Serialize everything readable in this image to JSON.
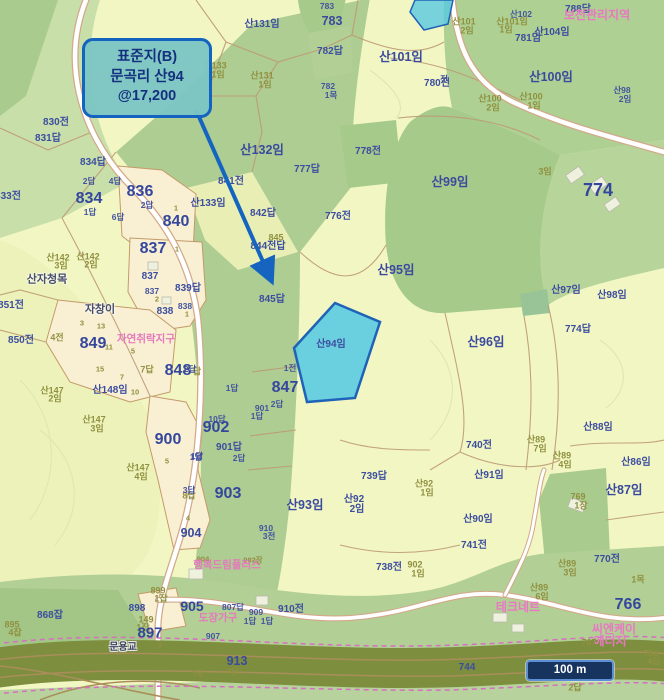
{
  "callout": {
    "line1": "표준지(B)",
    "line2": "문곡리 산94",
    "line3": "@17,200"
  },
  "scale_bar": {
    "label": "100 m"
  },
  "highlight": {
    "label": "산94임",
    "fill": "#57c9e2",
    "border": "#1f63b8"
  },
  "colors": {
    "accent_blue": "#1565c0",
    "callout_fill": "#7cc6c4",
    "callout_text": "#15307f",
    "parcel_blue_text": "#3c4d9f",
    "olive_text": "#8f9140",
    "pink_text": "#e678bd",
    "forest_green": "#aecd92",
    "pale_field": "#f2f6c3",
    "rail_band": "#7d8e3e"
  },
  "labels": [
    {
      "t": "783",
      "x": 327,
      "y": 6,
      "c": "bs"
    },
    {
      "t": "산131임",
      "x": 262,
      "y": 25,
      "c": "b"
    },
    {
      "t": "783",
      "x": 332,
      "y": 21,
      "c": "bm"
    },
    {
      "t": "782답",
      "x": 330,
      "y": 52,
      "c": "b"
    },
    {
      "t": "782",
      "x": 328,
      "y": 86,
      "c": "bs"
    },
    {
      "t": "1목",
      "x": 331,
      "y": 95,
      "c": "bs"
    },
    {
      "t": "산101임",
      "x": 401,
      "y": 57,
      "c": "bm"
    },
    {
      "t": "780전",
      "x": 437,
      "y": 84,
      "c": "b"
    },
    {
      "t": "산133",
      "x": 215,
      "y": 66,
      "c": "o"
    },
    {
      "t": "1임",
      "x": 218,
      "y": 75,
      "c": "o"
    },
    {
      "t": "산131",
      "x": 262,
      "y": 76,
      "c": "o"
    },
    {
      "t": "1임",
      "x": 265,
      "y": 85,
      "c": "o"
    },
    {
      "t": "산101",
      "x": 464,
      "y": 22,
      "c": "o"
    },
    {
      "t": "2임",
      "x": 467,
      "y": 31,
      "c": "o"
    },
    {
      "t": "산102",
      "x": 521,
      "y": 14,
      "c": "bs"
    },
    {
      "t": "산101임",
      "x": 512,
      "y": 22,
      "c": "o"
    },
    {
      "t": "1임",
      "x": 506,
      "y": 30,
      "c": "o"
    },
    {
      "t": "781임",
      "x": 528,
      "y": 39,
      "c": "b"
    },
    {
      "t": "산104임",
      "x": 552,
      "y": 33,
      "c": "b"
    },
    {
      "t": "788답",
      "x": 578,
      "y": 10,
      "c": "b"
    },
    {
      "t": "보전관리지역",
      "x": 597,
      "y": 15,
      "c": "pm"
    },
    {
      "t": "산100임",
      "x": 551,
      "y": 77,
      "c": "bm"
    },
    {
      "t": "산100",
      "x": 490,
      "y": 99,
      "c": "o"
    },
    {
      "t": "2임",
      "x": 493,
      "y": 108,
      "c": "o"
    },
    {
      "t": "산100",
      "x": 531,
      "y": 97,
      "c": "o"
    },
    {
      "t": "1임",
      "x": 534,
      "y": 106,
      "c": "o"
    },
    {
      "t": "산98",
      "x": 622,
      "y": 90,
      "c": "bs"
    },
    {
      "t": "2임",
      "x": 625,
      "y": 99,
      "c": "bs"
    },
    {
      "t": "전",
      "x": 444,
      "y": 79,
      "c": "bs"
    },
    {
      "t": "830전",
      "x": 56,
      "y": 123,
      "c": "b"
    },
    {
      "t": "831답",
      "x": 48,
      "y": 139,
      "c": "b"
    },
    {
      "t": "833전",
      "x": 8,
      "y": 197,
      "c": "b"
    },
    {
      "t": "834답",
      "x": 93,
      "y": 163,
      "c": "b"
    },
    {
      "t": "2답",
      "x": 89,
      "y": 181,
      "c": "bs"
    },
    {
      "t": "4답",
      "x": 115,
      "y": 181,
      "c": "bs"
    },
    {
      "t": "834",
      "x": 89,
      "y": 199,
      "c": "bl"
    },
    {
      "t": "1답",
      "x": 90,
      "y": 212,
      "c": "bs"
    },
    {
      "t": "836",
      "x": 140,
      "y": 192,
      "c": "bl"
    },
    {
      "t": "2답",
      "x": 147,
      "y": 205,
      "c": "bs"
    },
    {
      "t": "6답",
      "x": 118,
      "y": 217,
      "c": "bs"
    },
    {
      "t": "1",
      "x": 176,
      "y": 208,
      "c": "os"
    },
    {
      "t": "840",
      "x": 176,
      "y": 222,
      "c": "bl"
    },
    {
      "t": "837",
      "x": 153,
      "y": 249,
      "c": "bl"
    },
    {
      "t": "1",
      "x": 177,
      "y": 249,
      "c": "os"
    },
    {
      "t": "837",
      "x": 150,
      "y": 277,
      "c": "b"
    },
    {
      "t": "837",
      "x": 152,
      "y": 291,
      "c": "bs"
    },
    {
      "t": "2",
      "x": 157,
      "y": 299,
      "c": "os"
    },
    {
      "t": "839답",
      "x": 188,
      "y": 289,
      "c": "b"
    },
    {
      "t": "838",
      "x": 165,
      "y": 312,
      "c": "b"
    },
    {
      "t": "838",
      "x": 185,
      "y": 306,
      "c": "bs"
    },
    {
      "t": "1",
      "x": 187,
      "y": 314,
      "c": "os"
    },
    {
      "t": "산142",
      "x": 58,
      "y": 258,
      "c": "o"
    },
    {
      "t": "3임",
      "x": 61,
      "y": 266,
      "c": "o"
    },
    {
      "t": "산142",
      "x": 88,
      "y": 257,
      "c": "o"
    },
    {
      "t": "2임",
      "x": 91,
      "y": 265,
      "c": "o"
    },
    {
      "t": "산자청목",
      "x": 47,
      "y": 280,
      "c": "pd"
    },
    {
      "t": "자창이",
      "x": 100,
      "y": 310,
      "c": "pd"
    },
    {
      "t": "851전",
      "x": 11,
      "y": 306,
      "c": "b"
    },
    {
      "t": "850전",
      "x": 21,
      "y": 341,
      "c": "b"
    },
    {
      "t": "4전",
      "x": 57,
      "y": 338,
      "c": "o"
    },
    {
      "t": "849",
      "x": 93,
      "y": 344,
      "c": "bl"
    },
    {
      "t": "3",
      "x": 82,
      "y": 323,
      "c": "os"
    },
    {
      "t": "13",
      "x": 101,
      "y": 326,
      "c": "os"
    },
    {
      "t": "11",
      "x": 109,
      "y": 347,
      "c": "os"
    },
    {
      "t": "15",
      "x": 100,
      "y": 369,
      "c": "os"
    },
    {
      "t": "7",
      "x": 122,
      "y": 377,
      "c": "os"
    },
    {
      "t": "5",
      "x": 133,
      "y": 351,
      "c": "os"
    },
    {
      "t": "자연취락지구",
      "x": 146,
      "y": 339,
      "c": "p"
    },
    {
      "t": "7답",
      "x": 147,
      "y": 370,
      "c": "o"
    },
    {
      "t": "848",
      "x": 178,
      "y": 371,
      "c": "bl"
    },
    {
      "t": "답",
      "x": 197,
      "y": 372,
      "c": "o"
    },
    {
      "t": "산147",
      "x": 52,
      "y": 391,
      "c": "o"
    },
    {
      "t": "2임",
      "x": 55,
      "y": 399,
      "c": "o"
    },
    {
      "t": "산148임",
      "x": 110,
      "y": 391,
      "c": "b"
    },
    {
      "t": "10",
      "x": 135,
      "y": 392,
      "c": "os"
    },
    {
      "t": "산147",
      "x": 94,
      "y": 420,
      "c": "o"
    },
    {
      "t": "3임",
      "x": 97,
      "y": 429,
      "c": "o"
    },
    {
      "t": "900",
      "x": 168,
      "y": 440,
      "c": "bl"
    },
    {
      "t": "5",
      "x": 167,
      "y": 461,
      "c": "os"
    },
    {
      "t": "1답",
      "x": 196,
      "y": 457,
      "c": "bs"
    },
    {
      "t": "산147",
      "x": 138,
      "y": 468,
      "c": "o"
    },
    {
      "t": "4임",
      "x": 141,
      "y": 477,
      "c": "o"
    },
    {
      "t": "8답",
      "x": 189,
      "y": 496,
      "c": "o"
    },
    {
      "t": "4",
      "x": 188,
      "y": 518,
      "c": "os"
    },
    {
      "t": "904",
      "x": 191,
      "y": 533,
      "c": "bm"
    },
    {
      "t": "841전",
      "x": 231,
      "y": 182,
      "c": "b"
    },
    {
      "t": "842답",
      "x": 263,
      "y": 214,
      "c": "b"
    },
    {
      "t": "산132임",
      "x": 262,
      "y": 150,
      "c": "bm"
    },
    {
      "t": "산133임",
      "x": 208,
      "y": 204,
      "c": "b"
    },
    {
      "t": "777답",
      "x": 307,
      "y": 170,
      "c": "b"
    },
    {
      "t": "776전",
      "x": 338,
      "y": 217,
      "c": "b"
    },
    {
      "t": "778전",
      "x": 368,
      "y": 152,
      "c": "b"
    },
    {
      "t": "845",
      "x": 276,
      "y": 238,
      "c": "o"
    },
    {
      "t": "844전답",
      "x": 268,
      "y": 247,
      "c": "b"
    },
    {
      "t": "845답",
      "x": 272,
      "y": 300,
      "c": "b"
    },
    {
      "t": "산99임",
      "x": 450,
      "y": 182,
      "c": "bm"
    },
    {
      "t": "3임",
      "x": 545,
      "y": 172,
      "c": "o"
    },
    {
      "t": "774",
      "x": 598,
      "y": 190,
      "c": "bl",
      "s": 18
    },
    {
      "t": "산95임",
      "x": 396,
      "y": 270,
      "c": "bm"
    },
    {
      "t": "산97임",
      "x": 566,
      "y": 291,
      "c": "b"
    },
    {
      "t": "산98임",
      "x": 612,
      "y": 296,
      "c": "b"
    },
    {
      "t": "산94임",
      "x": 331,
      "y": 345,
      "c": "b"
    },
    {
      "t": "1전",
      "x": 290,
      "y": 368,
      "c": "bs"
    },
    {
      "t": "847",
      "x": 285,
      "y": 388,
      "c": "bl"
    },
    {
      "t": "2답",
      "x": 277,
      "y": 404,
      "c": "bs"
    },
    {
      "t": "901",
      "x": 262,
      "y": 408,
      "c": "bs"
    },
    {
      "t": "1답",
      "x": 257,
      "y": 416,
      "c": "bs"
    },
    {
      "t": "1답",
      "x": 232,
      "y": 388,
      "c": "bs"
    },
    {
      "t": "2답",
      "x": 190,
      "y": 369,
      "c": "bs"
    },
    {
      "t": "10답",
      "x": 217,
      "y": 419,
      "c": "bs"
    },
    {
      "t": "902",
      "x": 216,
      "y": 428,
      "c": "bl"
    },
    {
      "t": "901답",
      "x": 229,
      "y": 448,
      "c": "b"
    },
    {
      "t": "2답",
      "x": 239,
      "y": 458,
      "c": "bs"
    },
    {
      "t": "1답",
      "x": 197,
      "y": 456,
      "c": "bs"
    },
    {
      "t": "3답",
      "x": 189,
      "y": 490,
      "c": "bs"
    },
    {
      "t": "903",
      "x": 228,
      "y": 494,
      "c": "bl"
    },
    {
      "t": "산93임",
      "x": 305,
      "y": 505,
      "c": "bm"
    },
    {
      "t": "910",
      "x": 266,
      "y": 528,
      "c": "bs"
    },
    {
      "t": "3전",
      "x": 269,
      "y": 536,
      "c": "bs"
    },
    {
      "t": "산96임",
      "x": 486,
      "y": 342,
      "c": "bm"
    },
    {
      "t": "774답",
      "x": 578,
      "y": 330,
      "c": "b"
    },
    {
      "t": "740전",
      "x": 479,
      "y": 446,
      "c": "b"
    },
    {
      "t": "산91임",
      "x": 489,
      "y": 476,
      "c": "b"
    },
    {
      "t": "산89",
      "x": 536,
      "y": 440,
      "c": "o"
    },
    {
      "t": "7임",
      "x": 540,
      "y": 449,
      "c": "o"
    },
    {
      "t": "산89",
      "x": 562,
      "y": 456,
      "c": "o"
    },
    {
      "t": "4임",
      "x": 565,
      "y": 465,
      "c": "o"
    },
    {
      "t": "산88임",
      "x": 598,
      "y": 428,
      "c": "b"
    },
    {
      "t": "산86임",
      "x": 636,
      "y": 463,
      "c": "b"
    },
    {
      "t": "산87임",
      "x": 624,
      "y": 490,
      "c": "bm"
    },
    {
      "t": "769",
      "x": 578,
      "y": 497,
      "c": "o"
    },
    {
      "t": "1장",
      "x": 581,
      "y": 506,
      "c": "o"
    },
    {
      "t": "739답",
      "x": 374,
      "y": 477,
      "c": "b"
    },
    {
      "t": "산92",
      "x": 354,
      "y": 500,
      "c": "b"
    },
    {
      "t": "2임",
      "x": 357,
      "y": 510,
      "c": "b"
    },
    {
      "t": "산92",
      "x": 424,
      "y": 484,
      "c": "o"
    },
    {
      "t": "1임",
      "x": 427,
      "y": 493,
      "c": "o"
    },
    {
      "t": "산90임",
      "x": 478,
      "y": 520,
      "c": "b"
    },
    {
      "t": "741전",
      "x": 474,
      "y": 546,
      "c": "b"
    },
    {
      "t": "738전",
      "x": 389,
      "y": 568,
      "c": "b"
    },
    {
      "t": "902",
      "x": 415,
      "y": 565,
      "c": "o"
    },
    {
      "t": "1임",
      "x": 418,
      "y": 574,
      "c": "o"
    },
    {
      "t": "770전",
      "x": 607,
      "y": 560,
      "c": "b"
    },
    {
      "t": "산89",
      "x": 567,
      "y": 564,
      "c": "o"
    },
    {
      "t": "3임",
      "x": 570,
      "y": 573,
      "c": "o"
    },
    {
      "t": "1목",
      "x": 638,
      "y": 580,
      "c": "o"
    },
    {
      "t": "산89",
      "x": 539,
      "y": 588,
      "c": "o"
    },
    {
      "t": "6임",
      "x": 542,
      "y": 597,
      "c": "o"
    },
    {
      "t": "테크네트",
      "x": 518,
      "y": 607,
      "c": "pm"
    },
    {
      "t": "766",
      "x": 628,
      "y": 605,
      "c": "bl"
    },
    {
      "t": "씨엔케이",
      "x": 614,
      "y": 629,
      "c": "pm"
    },
    {
      "t": "에너지",
      "x": 610,
      "y": 641,
      "c": "pm"
    },
    {
      "t": "767",
      "x": 589,
      "y": 643,
      "c": "o"
    },
    {
      "t": "767",
      "x": 601,
      "y": 662,
      "c": "os"
    },
    {
      "t": "756",
      "x": 651,
      "y": 654,
      "c": "o"
    },
    {
      "t": "4답",
      "x": 654,
      "y": 662,
      "c": "o"
    },
    {
      "t": "746",
      "x": 536,
      "y": 672,
      "c": "o"
    },
    {
      "t": "744",
      "x": 467,
      "y": 668,
      "c": "b"
    },
    {
      "t": "2답",
      "x": 575,
      "y": 688,
      "c": "o"
    },
    {
      "t": "913",
      "x": 237,
      "y": 661,
      "c": "bm"
    },
    {
      "t": "3답",
      "x": 233,
      "y": 671,
      "c": "os"
    },
    {
      "t": "5답",
      "x": 198,
      "y": 673,
      "c": "os"
    },
    {
      "t": "868잡",
      "x": 50,
      "y": 616,
      "c": "b"
    },
    {
      "t": "895",
      "x": 12,
      "y": 625,
      "c": "o"
    },
    {
      "t": "4잡",
      "x": 15,
      "y": 633,
      "c": "o"
    },
    {
      "t": "898",
      "x": 137,
      "y": 609,
      "c": "b"
    },
    {
      "t": "149",
      "x": 146,
      "y": 620,
      "c": "o"
    },
    {
      "t": "1잡",
      "x": 143,
      "y": 628,
      "c": "o"
    },
    {
      "t": "897",
      "x": 150,
      "y": 633,
      "c": "bl",
      "s": 15
    },
    {
      "t": "3",
      "x": 160,
      "y": 645,
      "c": "os"
    },
    {
      "t": "문용교",
      "x": 123,
      "y": 648,
      "c": "w"
    },
    {
      "t": "904",
      "x": 203,
      "y": 559,
      "c": "os"
    },
    {
      "t": "902장",
      "x": 253,
      "y": 560,
      "c": "os"
    },
    {
      "t": "행복드림플러스",
      "x": 227,
      "y": 565,
      "c": "p"
    },
    {
      "t": "905",
      "x": 192,
      "y": 606,
      "c": "bl",
      "s": 14
    },
    {
      "t": "807답",
      "x": 233,
      "y": 607,
      "c": "bs"
    },
    {
      "t": "도장가구",
      "x": 218,
      "y": 618,
      "c": "p"
    },
    {
      "t": "909",
      "x": 256,
      "y": 612,
      "c": "bs"
    },
    {
      "t": "1답",
      "x": 250,
      "y": 621,
      "c": "bs"
    },
    {
      "t": "1답",
      "x": 267,
      "y": 621,
      "c": "bs"
    },
    {
      "t": "910전",
      "x": 291,
      "y": 610,
      "c": "b"
    },
    {
      "t": "907",
      "x": 213,
      "y": 636,
      "c": "bs"
    },
    {
      "t": "899",
      "x": 158,
      "y": 591,
      "c": "o"
    },
    {
      "t": "1잡",
      "x": 161,
      "y": 599,
      "c": "o"
    }
  ]
}
